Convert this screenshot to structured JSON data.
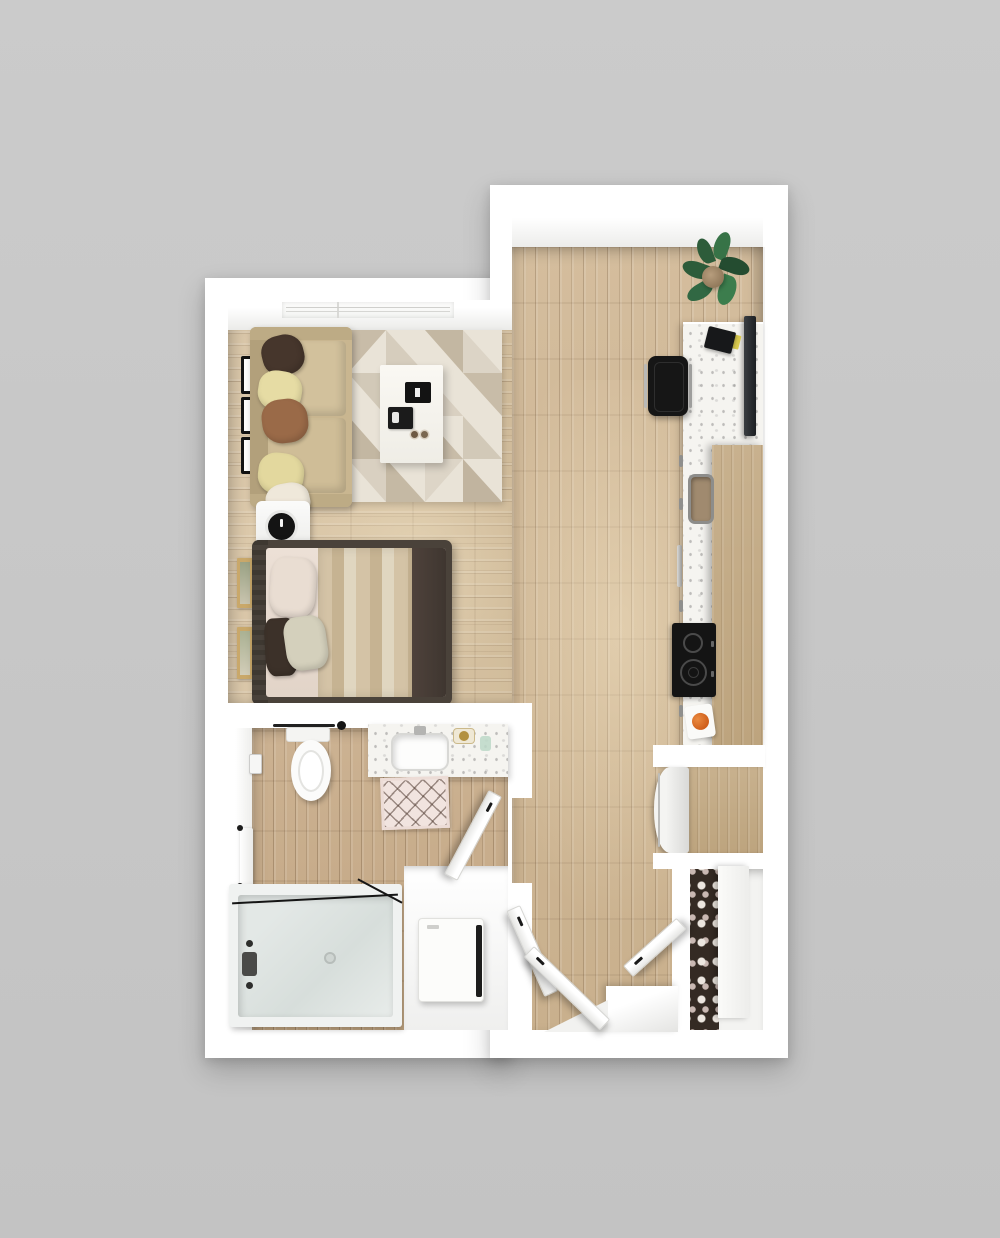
{
  "scene": {
    "title": "Studio apartment — 3D top-down floor plan render",
    "canvas_width": 1000,
    "canvas_height": 1238
  },
  "palette": {
    "background": "#c8c8c8",
    "wall": "#ffffff",
    "hall_floor": "#cfb795",
    "living_floor": "#d8c4a5",
    "bath_floor": "#c8ad8c",
    "terrazzo_counter": "#f5f4f0",
    "cabinet_wood": "#c4ac88",
    "sofa": "#c9b690",
    "rug_base": "#e9e3d7",
    "bed_frame": "#4a423a",
    "appliance_dark": "#1a1a1a",
    "plant_green": "#34663f",
    "fruit_orange": "#d2641e",
    "gold_accent": "#b3913f",
    "tub_glass": "#dde3e1"
  },
  "rooms": {
    "living": {
      "label": "Living / sleeping area",
      "items": {
        "window": "Window with blinds",
        "frames": "Black wall frames",
        "sofa": "Sofa with throw pillows",
        "rug": "Geometric area rug",
        "coffee_table": "Coffee table with trays",
        "side_table": "Bedside table with clock",
        "artwork": "Framed artwork",
        "bed": "Bed with blanket and pillows"
      }
    },
    "kitchen": {
      "label": "Kitchen",
      "items": {
        "plant": "Potted plant",
        "tv": "Wall-mounted TV",
        "counter": "Terrazzo counter peninsula",
        "stool": "Bar stool",
        "laptop": "Laptop and notebook",
        "sink": "Kitchen sink",
        "dishwasher": "Dishwasher handle",
        "cooktop": "Two-burner cooktop",
        "fruit_bowl": "Bowl with orange",
        "fridge": "Refrigerator",
        "pantry": "Pantry cabinet"
      }
    },
    "bathroom": {
      "label": "Bathroom",
      "items": {
        "toilet": "Toilet",
        "towel_bar": "Towel bar",
        "paper_holder": "Toilet paper holder",
        "vanity": "Vanity with sink",
        "gold_tray": "Gold soap tray",
        "glass_cup": "Glass tumbler",
        "bath_mat": "Lattice bath mat",
        "towel": "Hanging towel",
        "tub": "Bathtub with glass screen",
        "washer": "Washer-dryer under counter",
        "door": "Bathroom door"
      }
    },
    "entry": {
      "label": "Entry hall",
      "items": {
        "door_a": "Open door",
        "door_b": "Open door",
        "door_c": "Open door",
        "landing": "Entry landing",
        "closet": "Shoe closet",
        "shoe_rack": "Shoe rack",
        "closet_panel": "Closet sliding panel"
      }
    }
  }
}
